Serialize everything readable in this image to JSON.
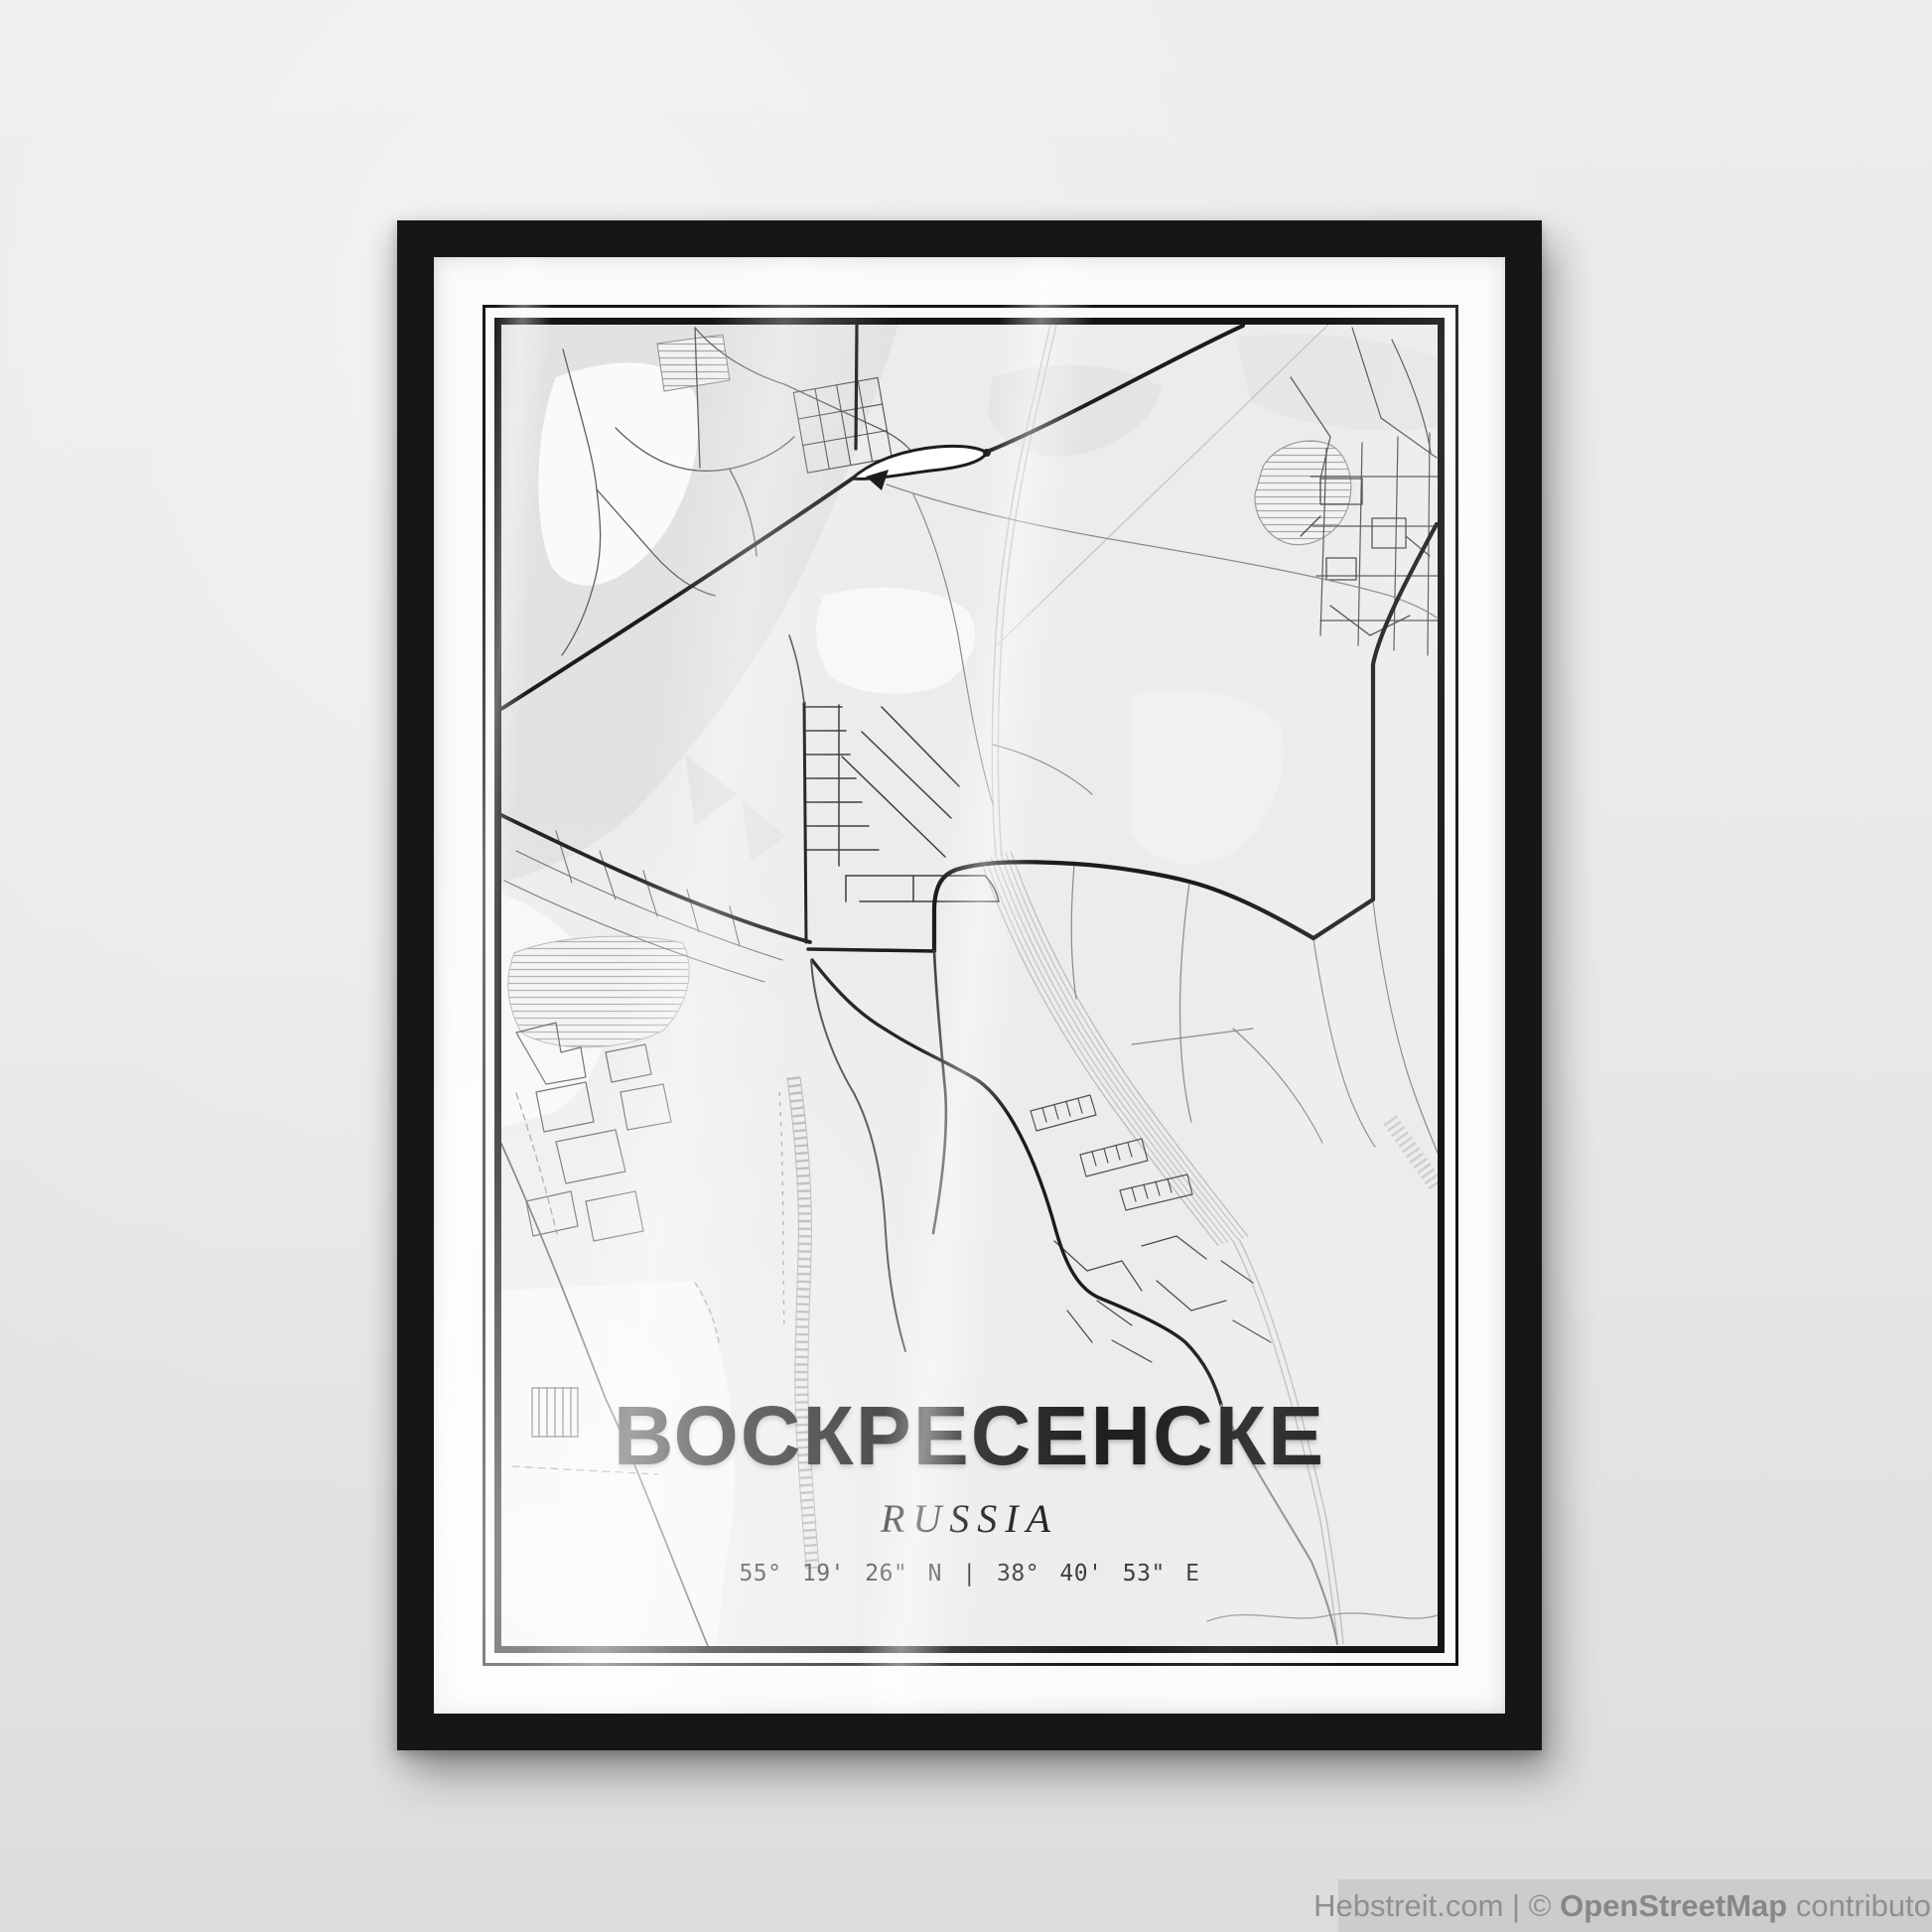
{
  "poster": {
    "title": "ВОСКРЕСЕНСКЕ",
    "subtitle": "RUSSIA",
    "coordinates": "55° 19' 26\" N | 38° 40' 53\" E"
  },
  "watermark": {
    "prefix": "Hebstreit.com | © ",
    "brand": "OpenStreetMap",
    "suffix": " contributors"
  },
  "style": {
    "wall_color": "#e9e9eb",
    "frame_color": "#161616",
    "map_background": "#ececee",
    "road_primary": "#1c1c1e",
    "railway_color": "#bfbfc2",
    "title_text": "#1f1f22",
    "watermark_bar": "#cbcbcd",
    "watermark_text": "#8f8f92"
  }
}
